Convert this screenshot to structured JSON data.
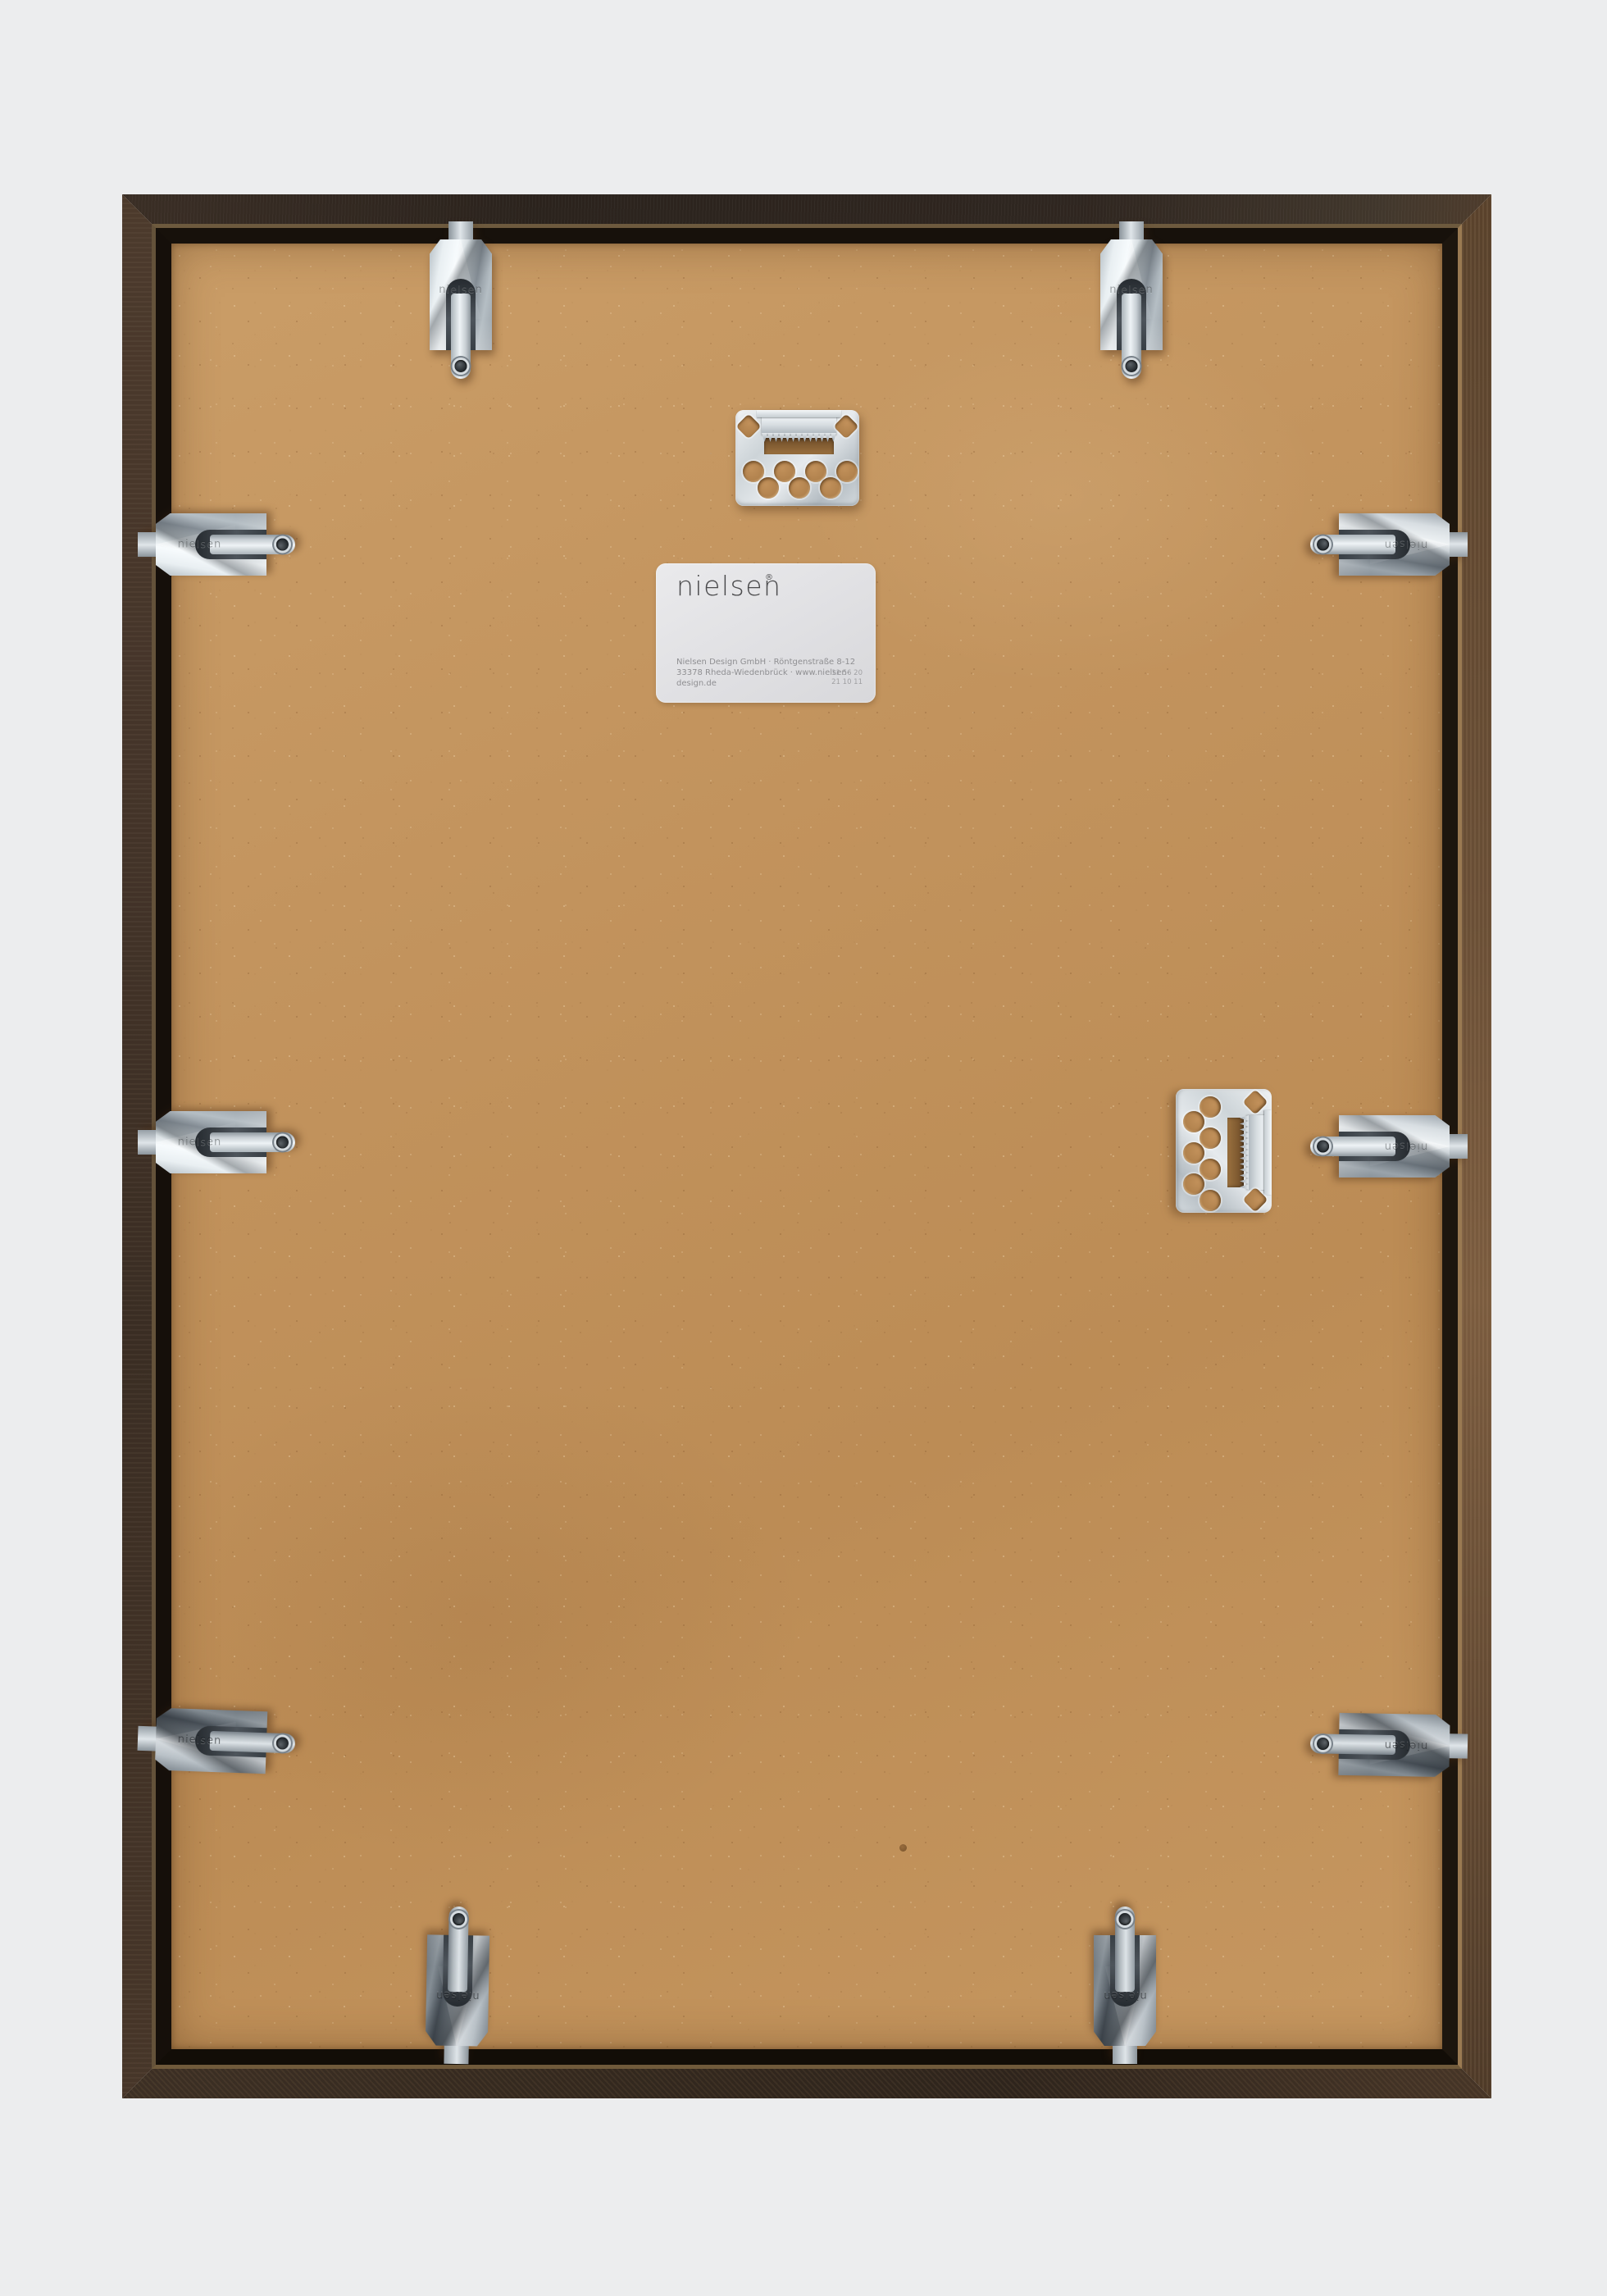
{
  "scene": {
    "background_color": "#ecedee"
  },
  "frame": {
    "moulding_color_top": "#2b231d",
    "moulding_color_right": "#6a4f36",
    "moulding_color_bottom": "#33281e",
    "moulding_color_left": "#443429",
    "groove_color": "#17110b",
    "backing_color": "#c2935d"
  },
  "label": {
    "brand": "nielsen",
    "registered": "®",
    "address_line1": "Nielsen Design GmbH · Röntgenstraße 8-12",
    "address_line2": "33378 Rheda-Wiedenbrück · www.nielsen-design.de",
    "stamp_line1": "11 56 20",
    "stamp_line2": "21 10 11"
  },
  "hardware": {
    "clip_brand_embossing": "nielsen"
  }
}
